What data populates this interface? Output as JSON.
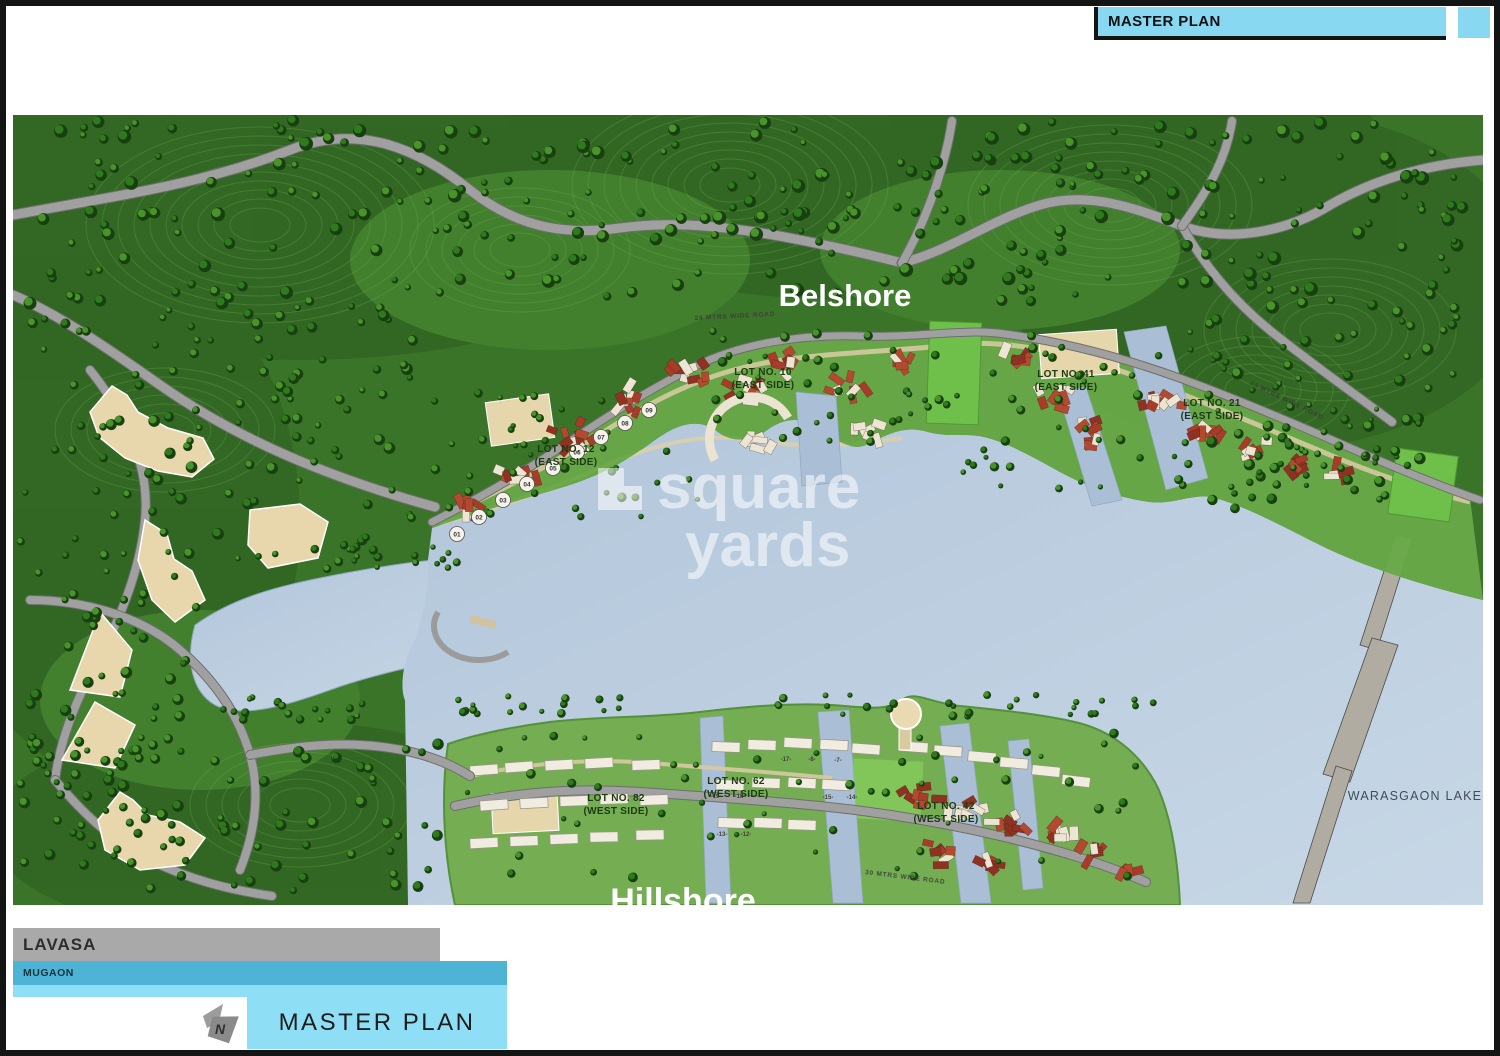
{
  "header": {
    "title": "MASTER PLAN"
  },
  "map": {
    "belshore_label": "Belshore",
    "hillshore_label": "Hillshore",
    "lake_label": "WARASGAON LAKE",
    "watermark": {
      "word1": "square",
      "word2": "yards"
    },
    "lots": [
      {
        "name": "LOT NO. 12",
        "side": "(EAST SIDE)"
      },
      {
        "name": "LOT NO. 10",
        "side": "(EAST SIDE)"
      },
      {
        "name": "LOT NO. 41",
        "side": "(EAST SIDE)"
      },
      {
        "name": "LOT NO. 21",
        "side": "(EAST SIDE)"
      },
      {
        "name": "LOT NO. 82",
        "side": "(WEST SIDE)"
      },
      {
        "name": "LOT NO. 62",
        "side": "(WEST SIDE)"
      },
      {
        "name": "LOT NO. 42",
        "side": "(WEST SIDE)"
      }
    ],
    "road_labels": [
      "24 MTRS WIDE ROAD",
      "24 MTRS WIDE ROAD",
      "30 MTRS WIDE ROAD"
    ],
    "plot_markers": [
      "01",
      "02",
      "03",
      "04",
      "05",
      "06",
      "07",
      "08",
      "09"
    ],
    "building_numbers": [
      "8",
      "7",
      "17",
      "15",
      "14",
      "19",
      "18",
      "13",
      "12"
    ]
  },
  "legend": {
    "project": "LAVASA",
    "location": "MUGAON",
    "plan_title": "MASTER PLAN",
    "compass_letter": "N"
  },
  "colors": {
    "header_bar": "#87d8f0",
    "lavasa_bar": "#a9a9a9",
    "mugaon_bar": "#4db4d6",
    "legend_panel": "#8edff5",
    "lake": "#b9cbde",
    "terrain_green": "#3a7429",
    "road_gray": "#a0a0a0",
    "building_beige": "#e8d6ac",
    "roof_red": "#a83c28"
  }
}
